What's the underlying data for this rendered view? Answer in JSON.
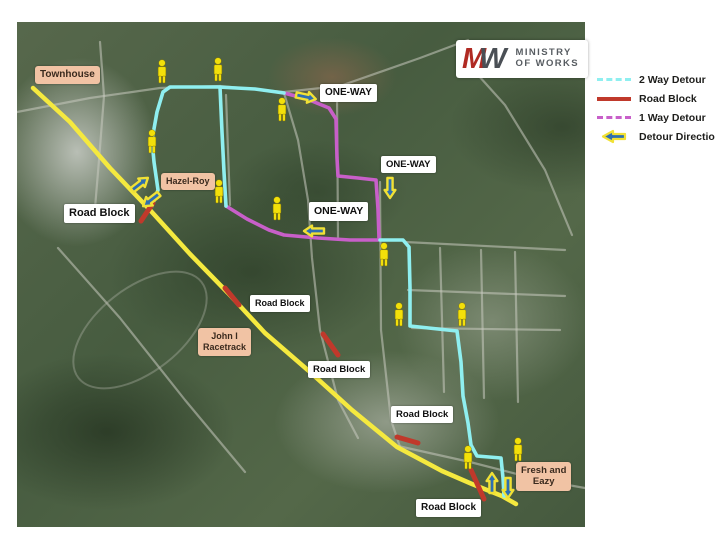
{
  "logo": {
    "monogram_letters": [
      "M",
      "W"
    ],
    "line1": "MINISTRY",
    "line2": "OF WORKS"
  },
  "legend": {
    "items": [
      {
        "label": "2 Way Detour",
        "type": "two-way"
      },
      {
        "label": "Road Block",
        "type": "road-block"
      },
      {
        "label": "1 Way Detour",
        "type": "one-way"
      },
      {
        "label": "Detour Direction",
        "type": "direction"
      }
    ]
  },
  "colors": {
    "road_yellow": "#F5E93F",
    "two_way_cyan": "#8FEFF0",
    "one_way_magenta": "#C85FC9",
    "road_block_red": "#C0392B",
    "arrow_blue": "#2E6FB0",
    "arrow_outline_yellow": "#F1E135",
    "pedestrian_yellow": "#F3E00A",
    "place_label_peach": "#F1C3A4",
    "minor_road_gray": "#c9cbbf"
  },
  "map": {
    "labels": [
      {
        "text": "Townhouse",
        "style": "peach",
        "x": 35,
        "y": 66,
        "fs": 10
      },
      {
        "text": "Hazel-Roy",
        "style": "peach",
        "x": 161,
        "y": 173,
        "fs": 9
      },
      {
        "text": "John I\nRacetrack",
        "style": "peach",
        "x": 198,
        "y": 328,
        "fs": 9
      },
      {
        "text": "Fresh and\nEazy",
        "style": "peach",
        "x": 516,
        "y": 462,
        "fs": 9.5
      },
      {
        "text": "ONE-WAY",
        "style": "white",
        "x": 320,
        "y": 84,
        "fs": 10
      },
      {
        "text": "ONE-WAY",
        "style": "white",
        "x": 381,
        "y": 156,
        "fs": 9.5
      },
      {
        "text": "ONE-WAY",
        "style": "white",
        "x": 309,
        "y": 202,
        "fs": 10.5
      },
      {
        "text": "Road Block",
        "style": "white",
        "x": 64,
        "y": 204,
        "fs": 11
      },
      {
        "text": "Road Block",
        "style": "white",
        "x": 250,
        "y": 295,
        "fs": 9
      },
      {
        "text": "Road Block",
        "style": "white",
        "x": 308,
        "y": 361,
        "fs": 9.5
      },
      {
        "text": "Road Block",
        "style": "white",
        "x": 391,
        "y": 406,
        "fs": 9.5
      },
      {
        "text": "Road Block",
        "style": "white",
        "x": 416,
        "y": 499,
        "fs": 10
      }
    ],
    "routes": {
      "main_road": [
        [
          33,
          88
        ],
        [
          70,
          122
        ],
        [
          110,
          168
        ],
        [
          150,
          210
        ],
        [
          190,
          254
        ],
        [
          228,
          293
        ],
        [
          265,
          333
        ],
        [
          310,
          372
        ],
        [
          352,
          410
        ],
        [
          397,
          447
        ],
        [
          442,
          471
        ],
        [
          472,
          484
        ],
        [
          502,
          496
        ],
        [
          516,
          504
        ]
      ],
      "two_way_detour": [
        [
          [
            152,
            206
          ],
          [
            158,
            190
          ],
          [
            154,
            162
          ],
          [
            152,
            140
          ],
          [
            157,
            112
          ],
          [
            163,
            92
          ],
          [
            170,
            87
          ],
          [
            218,
            87
          ],
          [
            255,
            89
          ],
          [
            284,
            93
          ]
        ],
        [
          [
            220,
            87
          ],
          [
            222,
            132
          ],
          [
            224,
            172
          ],
          [
            226,
            206
          ]
        ],
        [
          [
            380,
            240
          ],
          [
            403,
            240
          ],
          [
            409,
            247
          ],
          [
            410,
            288
          ],
          [
            410,
            326
          ],
          [
            438,
            329
          ],
          [
            457,
            331
          ],
          [
            461,
            362
          ],
          [
            463,
            396
          ],
          [
            468,
            423
          ],
          [
            471,
            445
          ],
          [
            477,
            456
          ],
          [
            501,
            458
          ],
          [
            503,
            478
          ],
          [
            504,
            496
          ]
        ]
      ],
      "one_way_detour": [
        [
          [
            284,
            93
          ],
          [
            307,
            99
          ],
          [
            329,
            108
          ],
          [
            336,
            119
          ],
          [
            337,
            158
          ],
          [
            338,
            176
          ],
          [
            358,
            178
          ],
          [
            376,
            180
          ],
          [
            378,
            209
          ],
          [
            379,
            238
          ]
        ],
        [
          [
            226,
            206
          ],
          [
            247,
            219
          ],
          [
            269,
            230
          ],
          [
            284,
            235
          ],
          [
            318,
            238
          ],
          [
            350,
            240
          ],
          [
            378,
            240
          ]
        ]
      ]
    },
    "road_blocks": [
      [
        153,
        203,
        141,
        221
      ],
      [
        225,
        288,
        239,
        305
      ],
      [
        323,
        334,
        338,
        355
      ],
      [
        397,
        437,
        418,
        443
      ],
      [
        471,
        470,
        484,
        499
      ]
    ],
    "pedestrians": [
      [
        162,
        72
      ],
      [
        218,
        70
      ],
      [
        152,
        142
      ],
      [
        282,
        110
      ],
      [
        219,
        192
      ],
      [
        277,
        209
      ],
      [
        384,
        255
      ],
      [
        399,
        315
      ],
      [
        462,
        315
      ],
      [
        468,
        458
      ],
      [
        518,
        450
      ]
    ],
    "detour_arrows": [
      {
        "x": 140,
        "y": 184,
        "angle": -38
      },
      {
        "x": 151,
        "y": 200,
        "angle": 142
      },
      {
        "x": 306,
        "y": 97,
        "angle": 12
      },
      {
        "x": 390,
        "y": 188,
        "angle": 90
      },
      {
        "x": 314,
        "y": 231,
        "angle": 180
      },
      {
        "x": 492,
        "y": 483,
        "angle": -90
      },
      {
        "x": 508,
        "y": 488,
        "angle": 90
      }
    ],
    "minor_roads": [
      [
        [
          17,
          112
        ],
        [
          90,
          98
        ],
        [
          160,
          88
        ],
        [
          220,
          86
        ],
        [
          284,
          92
        ],
        [
          340,
          86
        ],
        [
          420,
          58
        ],
        [
          468,
          40
        ]
      ],
      [
        [
          100,
          42
        ],
        [
          104,
          96
        ],
        [
          99,
          160
        ],
        [
          95,
          208
        ]
      ],
      [
        [
          226,
          95
        ],
        [
          230,
          205
        ]
      ],
      [
        [
          337,
          95
        ],
        [
          338,
          238
        ]
      ],
      [
        [
          380,
          182
        ],
        [
          381,
          330
        ],
        [
          391,
          420
        ],
        [
          400,
          447
        ]
      ],
      [
        [
          284,
          93
        ],
        [
          298,
          140
        ],
        [
          308,
          200
        ],
        [
          312,
          258
        ],
        [
          320,
          330
        ],
        [
          338,
          400
        ],
        [
          358,
          438
        ]
      ],
      [
        [
          405,
          242
        ],
        [
          565,
          250
        ]
      ],
      [
        [
          408,
          290
        ],
        [
          565,
          296
        ]
      ],
      [
        [
          412,
          328
        ],
        [
          560,
          330
        ]
      ],
      [
        [
          440,
          248
        ],
        [
          444,
          392
        ]
      ],
      [
        [
          481,
          250
        ],
        [
          484,
          398
        ]
      ],
      [
        [
          515,
          252
        ],
        [
          518,
          402
        ]
      ],
      [
        [
          398,
          446
        ],
        [
          470,
          462
        ],
        [
          540,
          480
        ],
        [
          585,
          488
        ]
      ],
      [
        [
          460,
          55
        ],
        [
          505,
          105
        ],
        [
          545,
          170
        ],
        [
          572,
          235
        ]
      ],
      [
        [
          58,
          248
        ],
        [
          120,
          318
        ],
        [
          185,
          400
        ],
        [
          245,
          472
        ]
      ]
    ],
    "racetrack_ellipse": {
      "cx": 140,
      "cy": 330,
      "rx": 78,
      "ry": 42,
      "rot": -38
    }
  }
}
